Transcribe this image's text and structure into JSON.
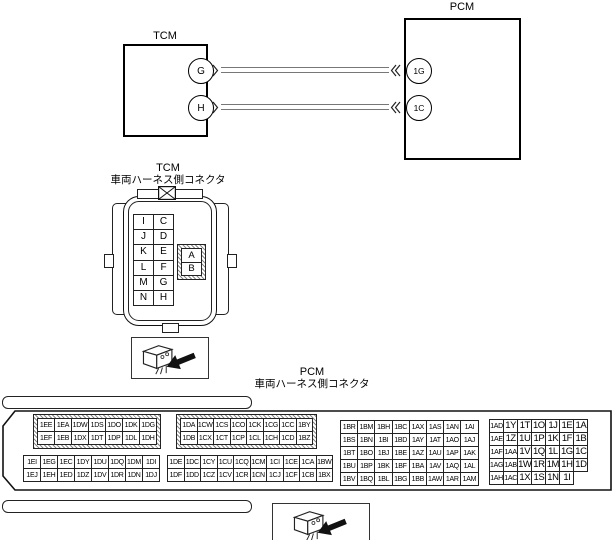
{
  "schematic": {
    "tcm": {
      "label": "TCM",
      "pins": [
        "G",
        "H"
      ]
    },
    "pcm": {
      "label": "PCM",
      "pins": [
        "1G",
        "1C"
      ]
    },
    "wires": [
      {
        "from": "G",
        "to": "1G"
      },
      {
        "from": "H",
        "to": "1C"
      }
    ]
  },
  "tcm_connector": {
    "label": "TCM",
    "sublabel": "車両ハーネス側コネクタ",
    "grid": [
      [
        "I",
        "C"
      ],
      [
        "J",
        "D"
      ],
      [
        "K",
        "E"
      ],
      [
        "L",
        "F"
      ],
      [
        "M",
        "G"
      ],
      [
        "N",
        "H"
      ]
    ],
    "ab_grid": [
      [
        "A"
      ],
      [
        "B"
      ]
    ]
  },
  "pcm_connector": {
    "label": "PCM",
    "sublabel": "車両ハーネス側コネクタ",
    "block1_top": [
      [
        "1EE",
        "1EA",
        "1DW",
        "1DS",
        "1DO",
        "1DK",
        "1DG"
      ],
      [
        "1EF",
        "1EB",
        "1DX",
        "1DT",
        "1DP",
        "1DL",
        "1DH"
      ]
    ],
    "block1_bottom": [
      [
        "1EI",
        "1EG",
        "1EC",
        "1DY",
        "1DU",
        "1DQ",
        "1DM",
        "1DI"
      ],
      [
        "1EJ",
        "1EH",
        "1ED",
        "1DZ",
        "1DV",
        "1DR",
        "1DN",
        "1DJ"
      ]
    ],
    "block2_top": [
      [
        "1DA",
        "1CW",
        "1CS",
        "1CO",
        "1CK",
        "1CG",
        "1CC",
        "1BY"
      ],
      [
        "1DB",
        "1CX",
        "1CT",
        "1CP",
        "1CL",
        "1CH",
        "1CD",
        "1BZ"
      ]
    ],
    "block2_bottom": [
      [
        "1DE",
        "1DC",
        "1CY",
        "1CU",
        "1CQ",
        "1CM",
        "1CI",
        "1CE",
        "1CA",
        "1BW"
      ],
      [
        "1DF",
        "1DD",
        "1CZ",
        "1CV",
        "1CR",
        "1CN",
        "1CJ",
        "1CF",
        "1CB",
        "1BX"
      ]
    ],
    "block3": [
      [
        "1BR",
        "1BM",
        "1BH",
        "1BC",
        "1AX",
        "1AS",
        "1AN",
        "1AI"
      ],
      [
        "1BS",
        "1BN",
        "1BI",
        "1BD",
        "1AY",
        "1AT",
        "1AO",
        "1AJ"
      ],
      [
        "1BT",
        "1BO",
        "1BJ",
        "1BE",
        "1AZ",
        "1AU",
        "1AP",
        "1AK"
      ],
      [
        "1BU",
        "1BP",
        "1BK",
        "1BF",
        "1BA",
        "1AV",
        "1AQ",
        "1AL"
      ],
      [
        "1BV",
        "1BQ",
        "1BL",
        "1BG",
        "1BB",
        "1AW",
        "1AR",
        "1AM"
      ]
    ],
    "block4": [
      [
        "1AD",
        "1Y",
        "1T",
        "1O",
        "1J",
        "1E",
        "1A"
      ],
      [
        "1AE",
        "1Z",
        "1U",
        "1P",
        "1K",
        "1F",
        "1B"
      ],
      [
        "1AF",
        "1AA",
        "1V",
        "1Q",
        "1L",
        "1G",
        "1C"
      ],
      [
        "1AG",
        "1AB",
        "1W",
        "1R",
        "1M",
        "1H",
        "1D"
      ],
      [
        "1AH",
        "1AC",
        "1X",
        "1S",
        "1N",
        "1I"
      ]
    ]
  },
  "icons": {
    "tcm_view_icon": "connector-view-arrow-icon",
    "pcm_view_icon": "connector-view-arrow-icon",
    "keying_icon": "x-box-icon"
  },
  "colors": {
    "line": "#000000",
    "wire": "#777777",
    "background": "#ffffff"
  }
}
